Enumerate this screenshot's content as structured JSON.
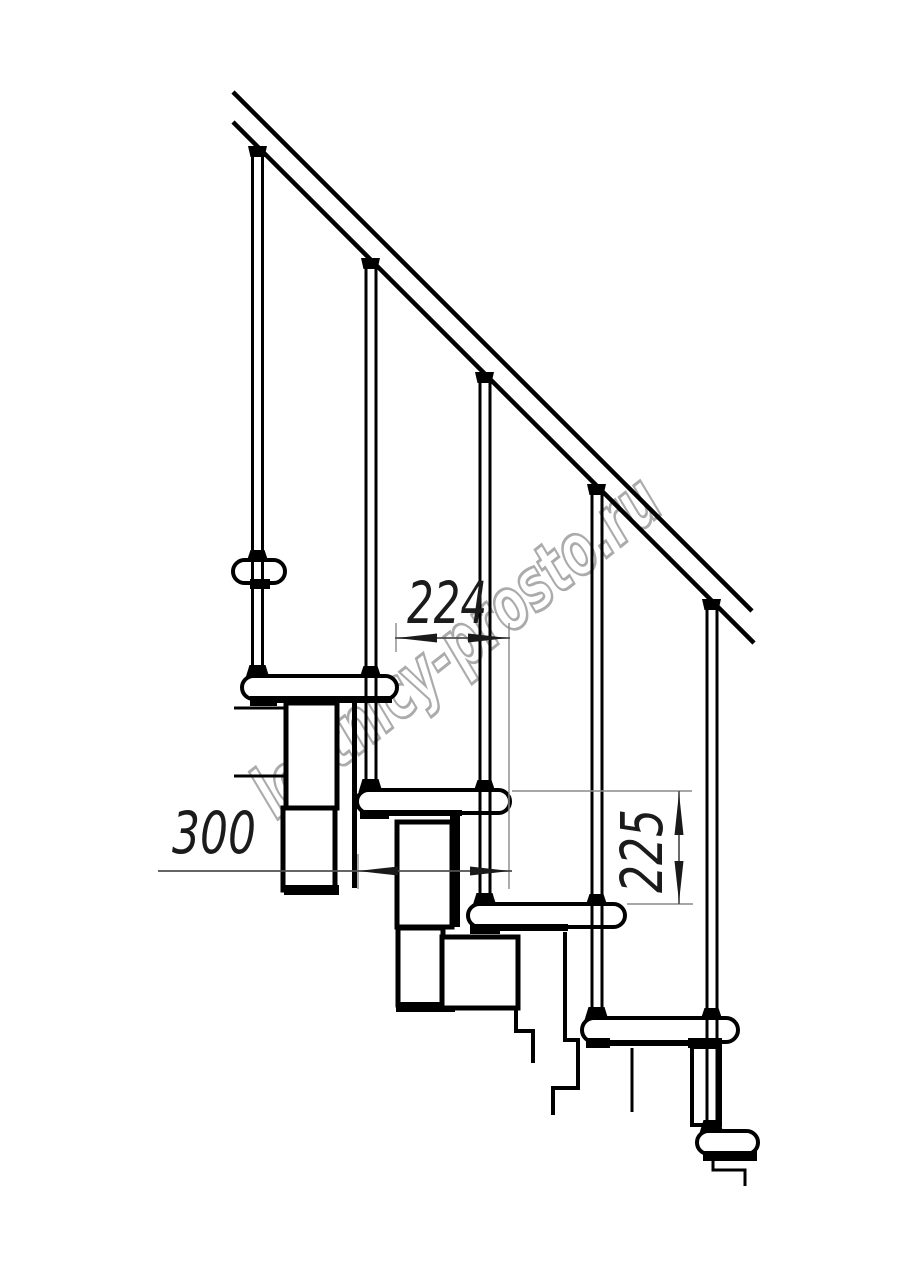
{
  "drawing": {
    "kind": "staircase-side-elevation-drawing",
    "watermark": "lestnicy-prosto.ru",
    "dimensions": [
      {
        "id": "step-run",
        "label": "224",
        "orientation": "horizontal"
      },
      {
        "id": "module-depth",
        "label": "300",
        "orientation": "horizontal"
      },
      {
        "id": "step-rise",
        "label": "225",
        "orientation": "vertical"
      }
    ],
    "colors": {
      "background": "#ffffff",
      "outline": "#000000",
      "dimension_line": "#4f4f4f",
      "extension_line": "#8a8a8a",
      "arrow": "#1a1a1a",
      "dimension_text": "#1b1b1b",
      "watermark": "#ababab"
    }
  }
}
